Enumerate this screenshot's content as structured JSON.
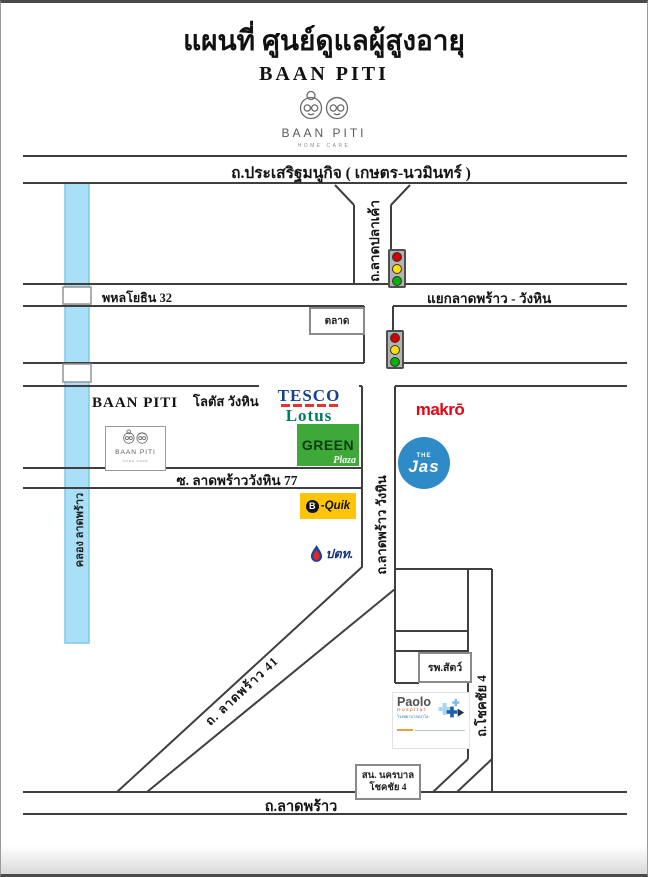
{
  "header": {
    "title": "แผนที่ ศูนย์ดูแลผู้สูงอายุ",
    "subtitle": "BAAN PITI",
    "logo": {
      "name": "BAAN PITI",
      "tagline": "HOME CARE"
    }
  },
  "roads": {
    "prasert": "ถ.ประเสริฐมนูกิจ ( เกษตร-นวมินทร์ )",
    "lat_pla_khao": "ถ.ลาดปลาเค้า",
    "phahonyothin_32": "พหลโยธิน 32",
    "intersection": "แยกลาดพร้าว - วังหิน",
    "soi_77": "ซ. ลาดพร้าววังหิน  77",
    "lat_phrao_wang_hin": "ถ.ลาดพร้าว  วังหิน",
    "khlong_lat_phrao": "คลอง ลาดพร้าว",
    "lat_phrao_41": "ถ. ลาดพร้าว  41",
    "chokchai_4": "ถ.โชคชัย 4",
    "lat_phrao": "ถ.ลาดพร้าว"
  },
  "places": {
    "market": "ตลาด",
    "baan_piti": "BAAN PITI",
    "lotus_thai": "โลตัส วังหิน",
    "map_logo": {
      "name": "BAAN PITI",
      "tagline": "HOME CARE"
    },
    "vet_hospital": "รพ.สัตว์",
    "police_line1": "สน. นครบาล",
    "police_line2": "โชคชัย 4"
  },
  "logos": {
    "tesco": "TESCO",
    "lotus": "Lotus",
    "green": "GREEN",
    "plaza": "Plaza",
    "makro": "makrō",
    "jas_the": "THE",
    "jas": "Jas",
    "bquik_b": "B",
    "bquik": "-Quik",
    "ptt": "ปตท.",
    "paolo": "Paolo",
    "paolo_hospital": "Hospital",
    "paolo_thai": "โรงพยาบาลเปาโล"
  },
  "colors": {
    "canal": "#a9e0f8",
    "road_line": "#3f3f3f",
    "tesco_blue": "#16418d",
    "tesco_red": "#e4342c",
    "lotus_teal": "#007a65",
    "green_bg": "#3ea838",
    "makro_red": "#e30613",
    "jas_blue": "#2e8bc8",
    "bquik_yellow": "#fdc408",
    "ptt_blue": "#15317e",
    "ptt_red": "#e32726",
    "paolo_gray": "#4f5054",
    "paolo_red": "#d9531e",
    "light_red": "#d40000",
    "light_yellow": "#ffe000",
    "light_green": "#00b400"
  }
}
